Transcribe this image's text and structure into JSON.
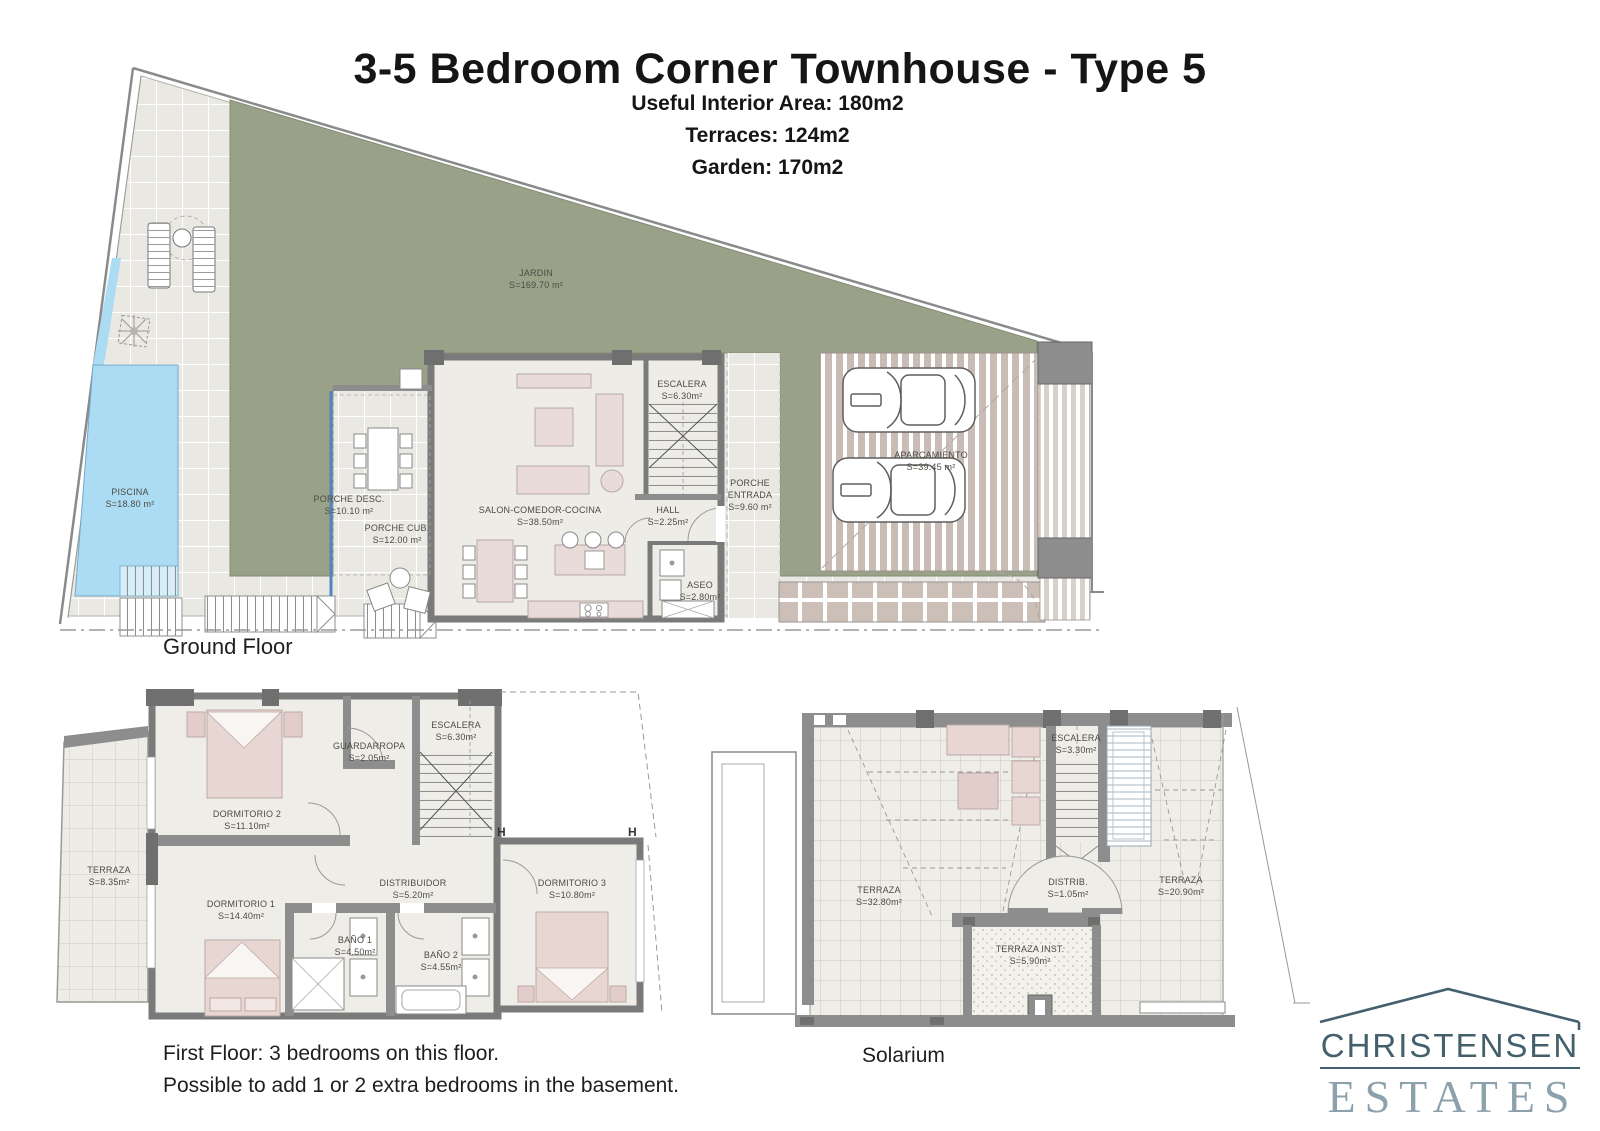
{
  "header": {
    "title": "3-5 Bedroom Corner Townhouse - Type 5",
    "subtitle_lines": [
      "Useful Interior Area: 180m2",
      "Terraces: 124m2",
      "Garden: 170m2"
    ]
  },
  "ground_floor": {
    "caption": "Ground Floor",
    "rooms": {
      "jardin": {
        "name": "JARDIN",
        "area": "S=169.70 m²"
      },
      "piscina": {
        "name": "PISCINA",
        "area": "S=18.80 m²"
      },
      "porche_desc": {
        "name": "PORCHE DESC.",
        "area": "S=10.10 m²"
      },
      "porche_cub": {
        "name": "PORCHE CUB.",
        "area": "S=12.00 m²"
      },
      "salon": {
        "name": "SALON-COMEDOR-COCINA",
        "area": "S=38.50m²"
      },
      "escalera": {
        "name": "ESCALERA",
        "area": "S=6.30m²"
      },
      "hall": {
        "name": "HALL",
        "area": "S=2.25m²"
      },
      "porche_entrada": {
        "name": "PORCHE",
        "name2": "ENTRADA",
        "area": "S=9.60 m²"
      },
      "aseo": {
        "name": "ASEO",
        "area": "S=2.80m²"
      },
      "aparcamiento": {
        "name": "APARCAMIENTO",
        "area": "S=39.45 m²"
      }
    }
  },
  "first_floor": {
    "caption_line1": "First Floor: 3 bedrooms on this floor.",
    "caption_line2": "Possible to add 1 or 2 extra bedrooms in the basement.",
    "markers": [
      "H",
      "H"
    ],
    "rooms": {
      "terraza": {
        "name": "TERRAZA",
        "area": "S=8.35m²"
      },
      "dormitorio2": {
        "name": "DORMITORIO 2",
        "area": "S=11.10m²"
      },
      "guardarropa": {
        "name": "GUARDARROPA",
        "area": "S=2.05m²"
      },
      "escalera": {
        "name": "ESCALERA",
        "area": "S=6.30m²"
      },
      "dormitorio1": {
        "name": "DORMITORIO 1",
        "area": "S=14.40m²"
      },
      "distribuidor": {
        "name": "DISTRIBUIDOR",
        "area": "S=5.20m²"
      },
      "dormitorio3": {
        "name": "DORMITORIO 3",
        "area": "S=10.80m²"
      },
      "bano1": {
        "name": "BAÑO 1",
        "area": "S=4.50m²"
      },
      "bano2": {
        "name": "BAÑO 2",
        "area": "S=4.55m²"
      }
    }
  },
  "solarium": {
    "caption": "Solarium",
    "rooms": {
      "terraza_left": {
        "name": "TERRAZA",
        "area": "S=32.80m²"
      },
      "escalera": {
        "name": "ESCALERA",
        "area": "S=3.30m²"
      },
      "distrib": {
        "name": "DISTRIB.",
        "area": "S=1.05m²"
      },
      "terraza_right": {
        "name": "TERRAZA",
        "area": "S=20.90m²"
      },
      "terraza_inst": {
        "name": "TERRAZA INST.",
        "area": "S=5.90m²"
      }
    }
  },
  "logo": {
    "line1": "CHRISTENSEN",
    "line2": "ESTATES"
  },
  "colors": {
    "garden": "#9aa189",
    "pool": "#abdcf4",
    "wall": "#8d8d8d",
    "tile": "#eae8e2",
    "furniture": "#e8d6d3",
    "logo_dark": "#44606c",
    "logo_light": "#8ca1ac"
  }
}
